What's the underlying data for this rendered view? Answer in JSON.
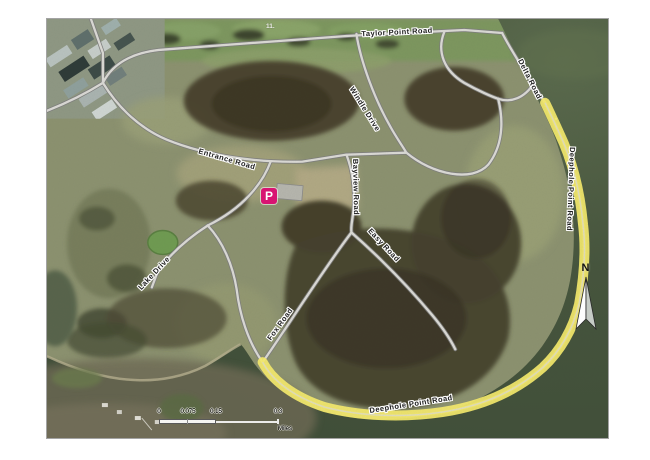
{
  "roads": {
    "labels": [
      {
        "text": "Taylor Point Road"
      },
      {
        "text": "Delta Road"
      },
      {
        "text": "Deephole Point Road"
      },
      {
        "text": "Entrance Road"
      },
      {
        "text": "Windle Drive"
      },
      {
        "text": "Bayview Road"
      },
      {
        "text": "Easy Road"
      },
      {
        "text": "Fox Road"
      },
      {
        "text": "Lake Drive"
      },
      {
        "text": "Deephole Point Road"
      }
    ]
  },
  "markers": {
    "parking_label": "P",
    "basemap_route_marker": "11."
  },
  "north_arrow": {
    "label": "N"
  },
  "scale_bar": {
    "ticks": [
      "0",
      "0.075",
      "0.15",
      "0.3"
    ],
    "unit": "Miles"
  },
  "colors": {
    "water": "#46553d",
    "cove_water": "#6e6a54",
    "land": "#8c9270",
    "woods": "#453f2c",
    "road_fill": "#dbdad6",
    "road_casing": "#7e7e7e",
    "trail_highlight": "#f6ec6d",
    "parking_icon": "#d81472"
  }
}
